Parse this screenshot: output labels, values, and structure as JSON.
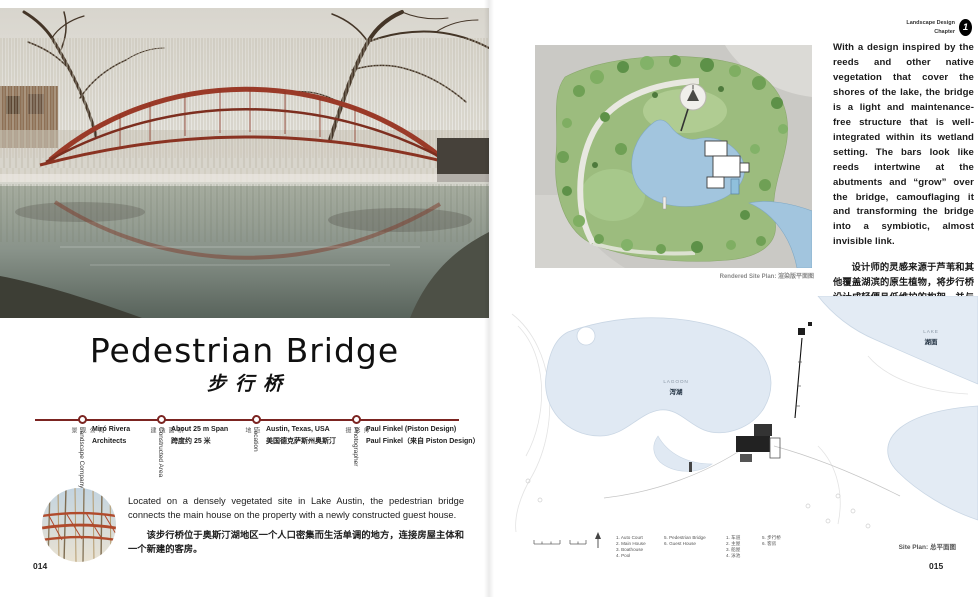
{
  "chapter_tag": {
    "line1": "Landscape Design",
    "line2": "Chapter",
    "badge": "1"
  },
  "left_page": {
    "title_en": "Pedestrian Bridge",
    "title_zh": "步行桥",
    "timeline": [
      {
        "label_en": "Landscape Company",
        "label_zh": "景观公司",
        "value_en": "Miró Rivera Architects",
        "value_zh": ""
      },
      {
        "label_en": "Constructed Area",
        "label_zh": "建造面积",
        "value_en": "About 25 m Span",
        "value_zh": "跨度约 25 米"
      },
      {
        "label_en": "Location",
        "label_zh": "地点",
        "value_en": "Austin, Texas, USA",
        "value_zh": "美国德克萨斯州奥斯汀"
      },
      {
        "label_en": "Photographer",
        "label_zh": "摄影师",
        "value_en": "Paul Finkel (Piston Design)",
        "value_zh": "Paul Finkel（来自 Piston Design）"
      }
    ],
    "intro_en": "Located on a densely vegetated site in Lake Austin, the pedestrian bridge connects the main house on the property with a newly constructed guest house.",
    "intro_zh": "该步行桥位于奥斯汀湖地区一个人口密集而生活单调的地方，连接房屋主体和一个新建的客房。",
    "page_number": "014"
  },
  "right_page": {
    "paragraph_en": "With a design inspired by the reeds and other native vegetation that cover the shores of the lake, the bridge is a light and maintenance-free structure that is well-integrated within its wetland setting. The bars look like reeds intertwine at the abutments and “grow” over the bridge, camouflaging it and transforming the bridge into a symbiotic, almost invisible link.",
    "paragraph_zh": "设计师的灵感来源于芦苇和其他覆盖湖滨的原生植物，将步行桥设计成轻便且低维护的构架，并与周边的沼泽环境相协调。桥栏宛如芦苇般首尾缠绕，“生长”在桥面之上，把整座桥伪装成一条无形的共生链条。",
    "rendered_plan_caption": "Rendered Site Plan: 渲染版平面图",
    "site_plan": {
      "caption": "Site Plan: 总平面图",
      "lagoon_label_en": "LAGOON",
      "lagoon_label_zh": "泻湖",
      "lake_label_en": "LAKE",
      "lake_label_zh": "湖面",
      "legend_en_col1": [
        "1. Auto Court",
        "2. Main House",
        "3. Boathouse",
        "4. Pool"
      ],
      "legend_en_col2": [
        "5. Pedestrian Bridge",
        "6. Guest House"
      ],
      "legend_zh_col1": [
        "1. 车道",
        "2. 主屋",
        "3. 船屋",
        "4. 泳池"
      ],
      "legend_zh_col2": [
        "5. 步行桥",
        "6. 客房"
      ]
    },
    "page_number": "015"
  },
  "colors": {
    "timeline_red": "#7b2421",
    "bridge_red": "#9a3a28",
    "plan_green": "#9cbc7e",
    "water_blue": "#a2c5de",
    "pale_water": "#e3ebf4"
  }
}
